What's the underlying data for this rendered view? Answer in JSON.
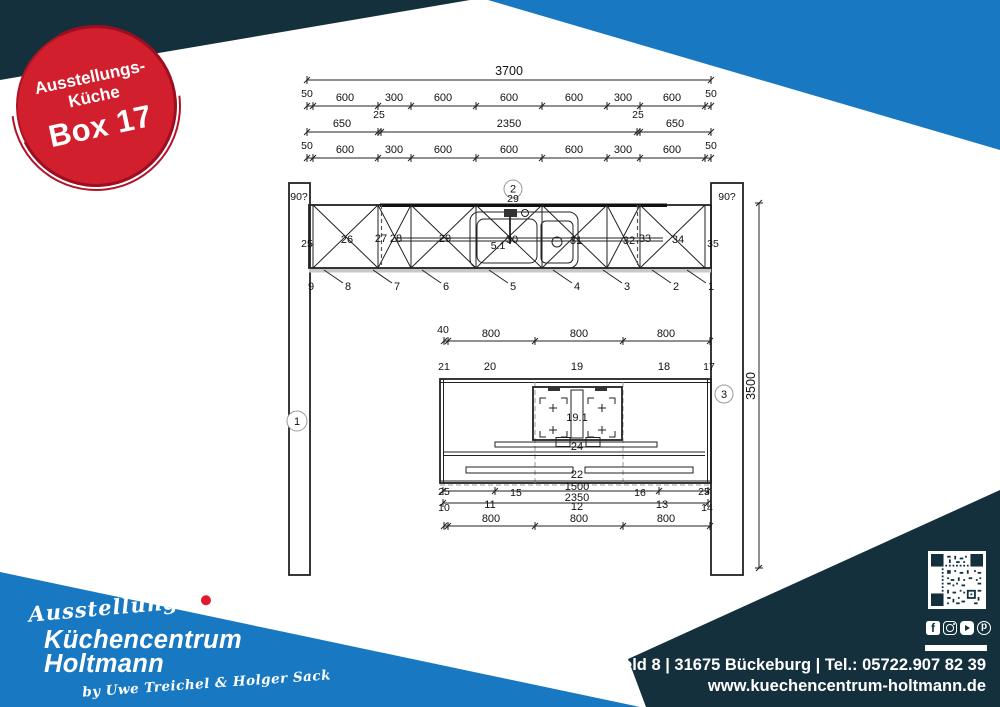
{
  "colors": {
    "navy": "#15303d",
    "blue": "#1878c1",
    "red": "#d11f2e"
  },
  "badge": {
    "line1": "Ausstellungs-",
    "line2": "Küche",
    "line3": "Box 17"
  },
  "drawing": {
    "angle_left": "90?",
    "angle_right": "90?",
    "circle1": "1",
    "circle2": "2",
    "circle3": "3",
    "top_dims": {
      "total": "3700",
      "row2": [
        "50",
        "600",
        "300",
        "600",
        "600",
        "600",
        "300",
        "600",
        "50"
      ],
      "row3": [
        "650",
        "25",
        "2350",
        "25",
        "650"
      ],
      "row4": [
        "50",
        "600",
        "300",
        "600",
        "600",
        "600",
        "300",
        "600",
        "50"
      ]
    },
    "wall_row": {
      "strip": "29",
      "items": [
        "25",
        "26",
        "27",
        "28",
        "29",
        "5.1",
        "30",
        "31",
        "32",
        "33",
        "34",
        "35"
      ],
      "callouts": [
        "9",
        "8",
        "7",
        "6",
        "5",
        "4",
        "3",
        "2",
        "1"
      ]
    },
    "island": {
      "top_dims": [
        "40",
        "800",
        "800",
        "800"
      ],
      "top_callouts": [
        "21",
        "20",
        "19",
        "18",
        "17"
      ],
      "hob": "19.1",
      "vent": "24",
      "front": "22",
      "dim_1500": "1500",
      "dim_2350": "2350",
      "seg15": "15",
      "seg16": "16",
      "edge_left": "25",
      "edge_right": "25",
      "bottom_callouts": [
        "10",
        "11",
        "12",
        "13",
        "14"
      ],
      "bottom_dims": [
        "800",
        "800",
        "800"
      ]
    },
    "height_dim": "3500"
  },
  "footer": {
    "script_left": "Ausstellungs",
    "script_right": "Küche",
    "brand_line1": "Küchencentrum",
    "brand_line2": "Holtmann",
    "byline": "by Uwe Treichel & Holger Sack",
    "address": "Großes Feld 8 | 31675 Bückeburg | Tel.: 05722.907 82 39",
    "website": "www.kuechencentrum-holtmann.de",
    "social": [
      "facebook",
      "instagram",
      "youtube",
      "pinterest"
    ]
  }
}
